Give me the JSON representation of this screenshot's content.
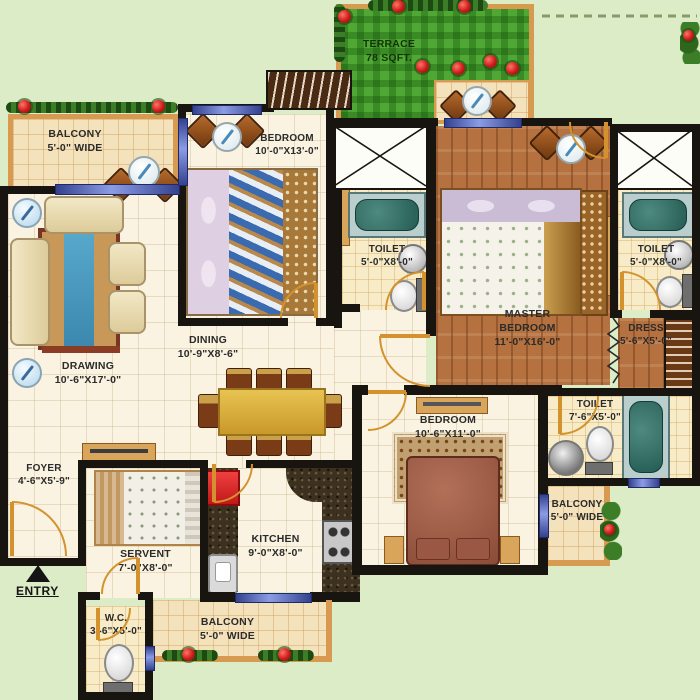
{
  "plan_title": "apartment-floor-plan",
  "rooms": {
    "balcony_tl": {
      "name": "BALCONY",
      "dims": "5'-0\" WIDE"
    },
    "drawing": {
      "name": "DRAWING",
      "dims": "10'-6\"X17'-0\""
    },
    "bedroom1": {
      "name": "BEDROOM",
      "dims": "10'-0\"X13'-0\""
    },
    "dining": {
      "name": "DINING",
      "dims": "10'-9\"X8'-6\""
    },
    "terrace": {
      "name": "TERRACE",
      "dims": "78 SQFT."
    },
    "toilet_c": {
      "name": "TOILET",
      "dims": "5'-0\"X8'-0\""
    },
    "master": {
      "name": "MASTER BEDROOM",
      "dims": "11'-0\"X16'-0\""
    },
    "toilet_r": {
      "name": "TOILET",
      "dims": "5'-0\"X8'-0\""
    },
    "dress": {
      "name": "DRESS",
      "dims": "5'-6\"X5'-0\""
    },
    "toilet_br": {
      "name": "TOILET",
      "dims": "7'-6\"X5'-0\""
    },
    "bedroom2": {
      "name": "BEDROOM",
      "dims": "10'-6\"X11'-0\""
    },
    "balcony_br": {
      "name": "BALCONY",
      "dims": "5'-0\" WIDE"
    },
    "balcony_bc": {
      "name": "BALCONY",
      "dims": "5'-0\" WIDE"
    },
    "kitchen": {
      "name": "KITCHEN",
      "dims": "9'-0\"X8'-0\""
    },
    "servant": {
      "name": "SERVENT",
      "dims": "7'-0\"X8'-0\""
    },
    "foyer": {
      "name": "FOYER",
      "dims": "4'-6\"X5'-9\""
    },
    "wc": {
      "name": "W.C.",
      "dims": "3'-6\"X5'-0\""
    },
    "entry": {
      "label": "ENTRY"
    }
  },
  "colors": {
    "background": "#dcecc6",
    "wall": "#181410",
    "floor_cream": "#faf3e2",
    "floor_tan": "#f4e2bc",
    "wood": "#b5713f",
    "terrace_green": "#4fa834",
    "window_blue": "#8c9ce4",
    "door_orange": "#d4922e",
    "granite": "#3c3120",
    "accent_red": "#e03030"
  }
}
